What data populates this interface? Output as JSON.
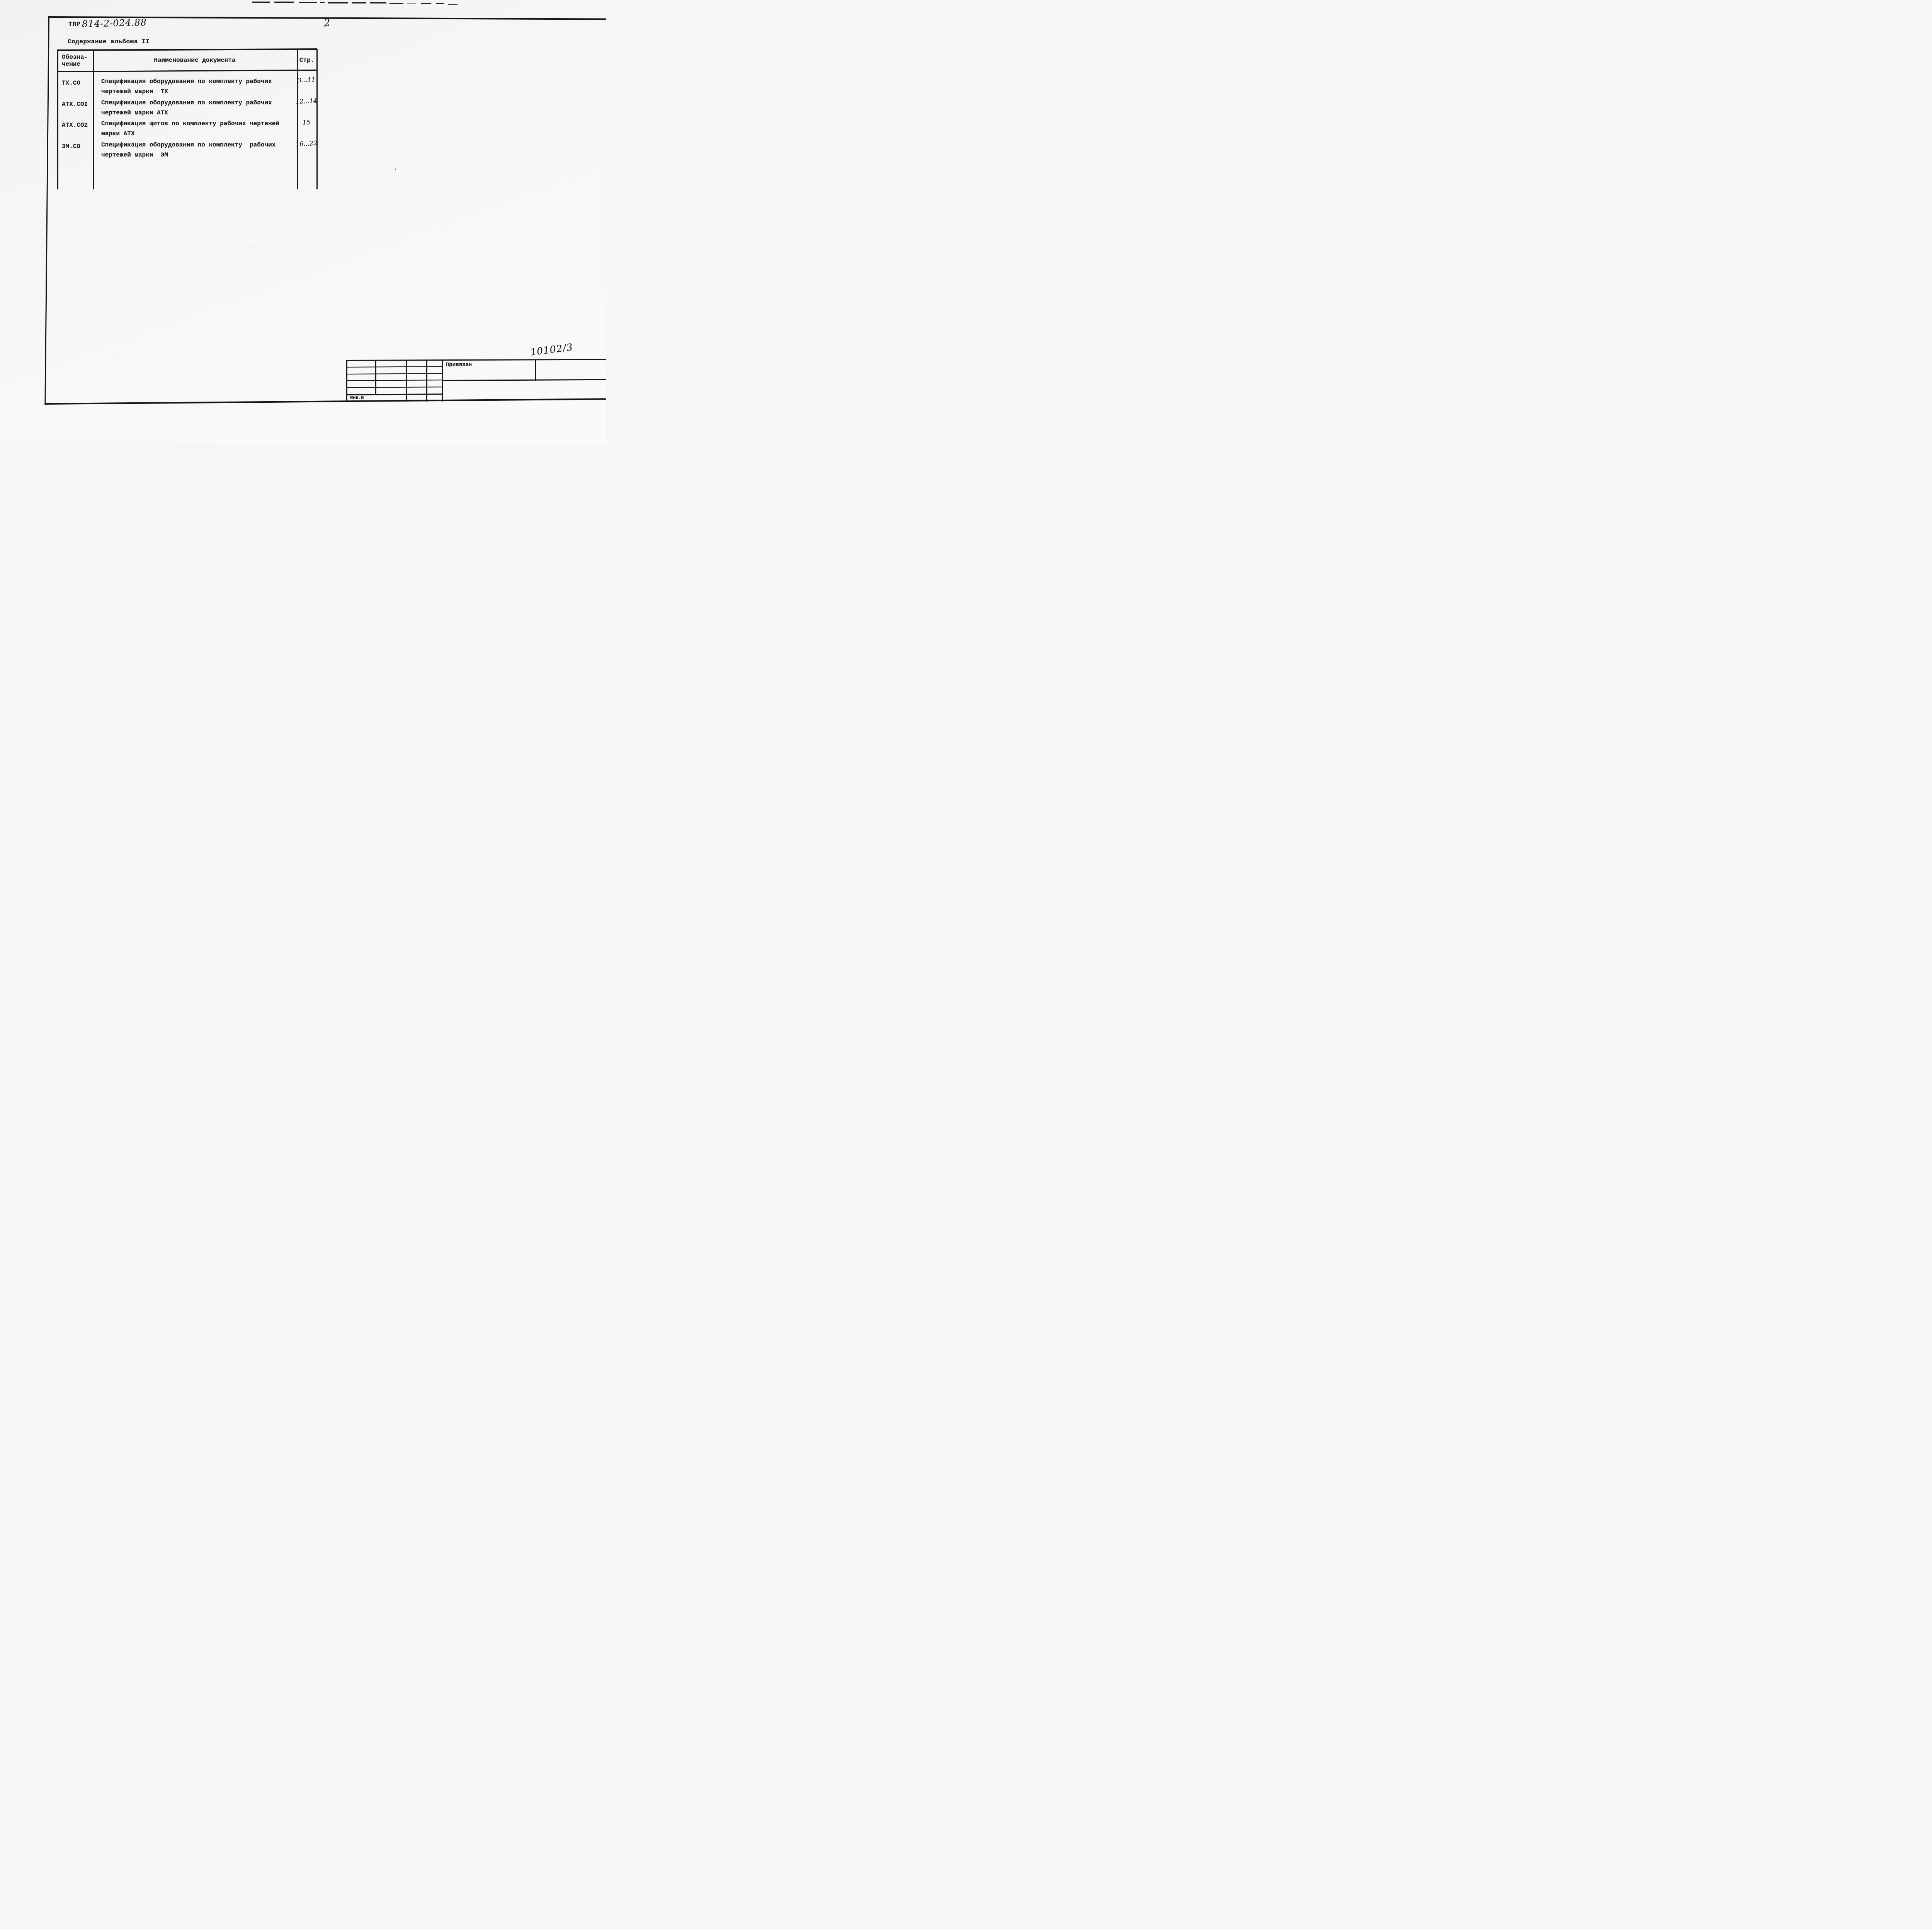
{
  "document": {
    "code_prefix": "ТПР",
    "code_number_handwritten": "814-2-024.88",
    "page_number_handwritten": "2",
    "section_title": "Содержание альбома II"
  },
  "contents_table": {
    "headers": {
      "designation_line1": "Обозна-",
      "designation_line2": "чение",
      "document_name": "Наименование документа",
      "pages": "Стр."
    },
    "rows": [
      {
        "designation": "ТХ.СО",
        "name_line1": "Спецификация оборудования по комплекту рабочих",
        "name_line2": "чертежей марки  ТХ",
        "pages": "3...11"
      },
      {
        "designation": "АТХ.СОI",
        "name_line1": "Спецификация оборудования по комплекту рабочих",
        "name_line2": "чертежей марки АТХ",
        "pages": "12...14"
      },
      {
        "designation": "АТХ.СО2",
        "name_line1": "Спецификация щитов по комплекту рабочих чертежей",
        "name_line2": "марки АТХ",
        "pages": "15"
      },
      {
        "designation": "ЭМ.СО",
        "name_line1": "Спецификация оборудования по комплекту  рабочих",
        "name_line2": "чертежей марки  ЭМ",
        "pages": "16...22"
      }
    ]
  },
  "title_block": {
    "handwritten_number": "10102/3",
    "binding_label": "Привязан",
    "inventory_label": "Инв.№"
  },
  "colors": {
    "paper": "#f6f6f4",
    "ink": "#1a1a18",
    "line": "#161616"
  }
}
